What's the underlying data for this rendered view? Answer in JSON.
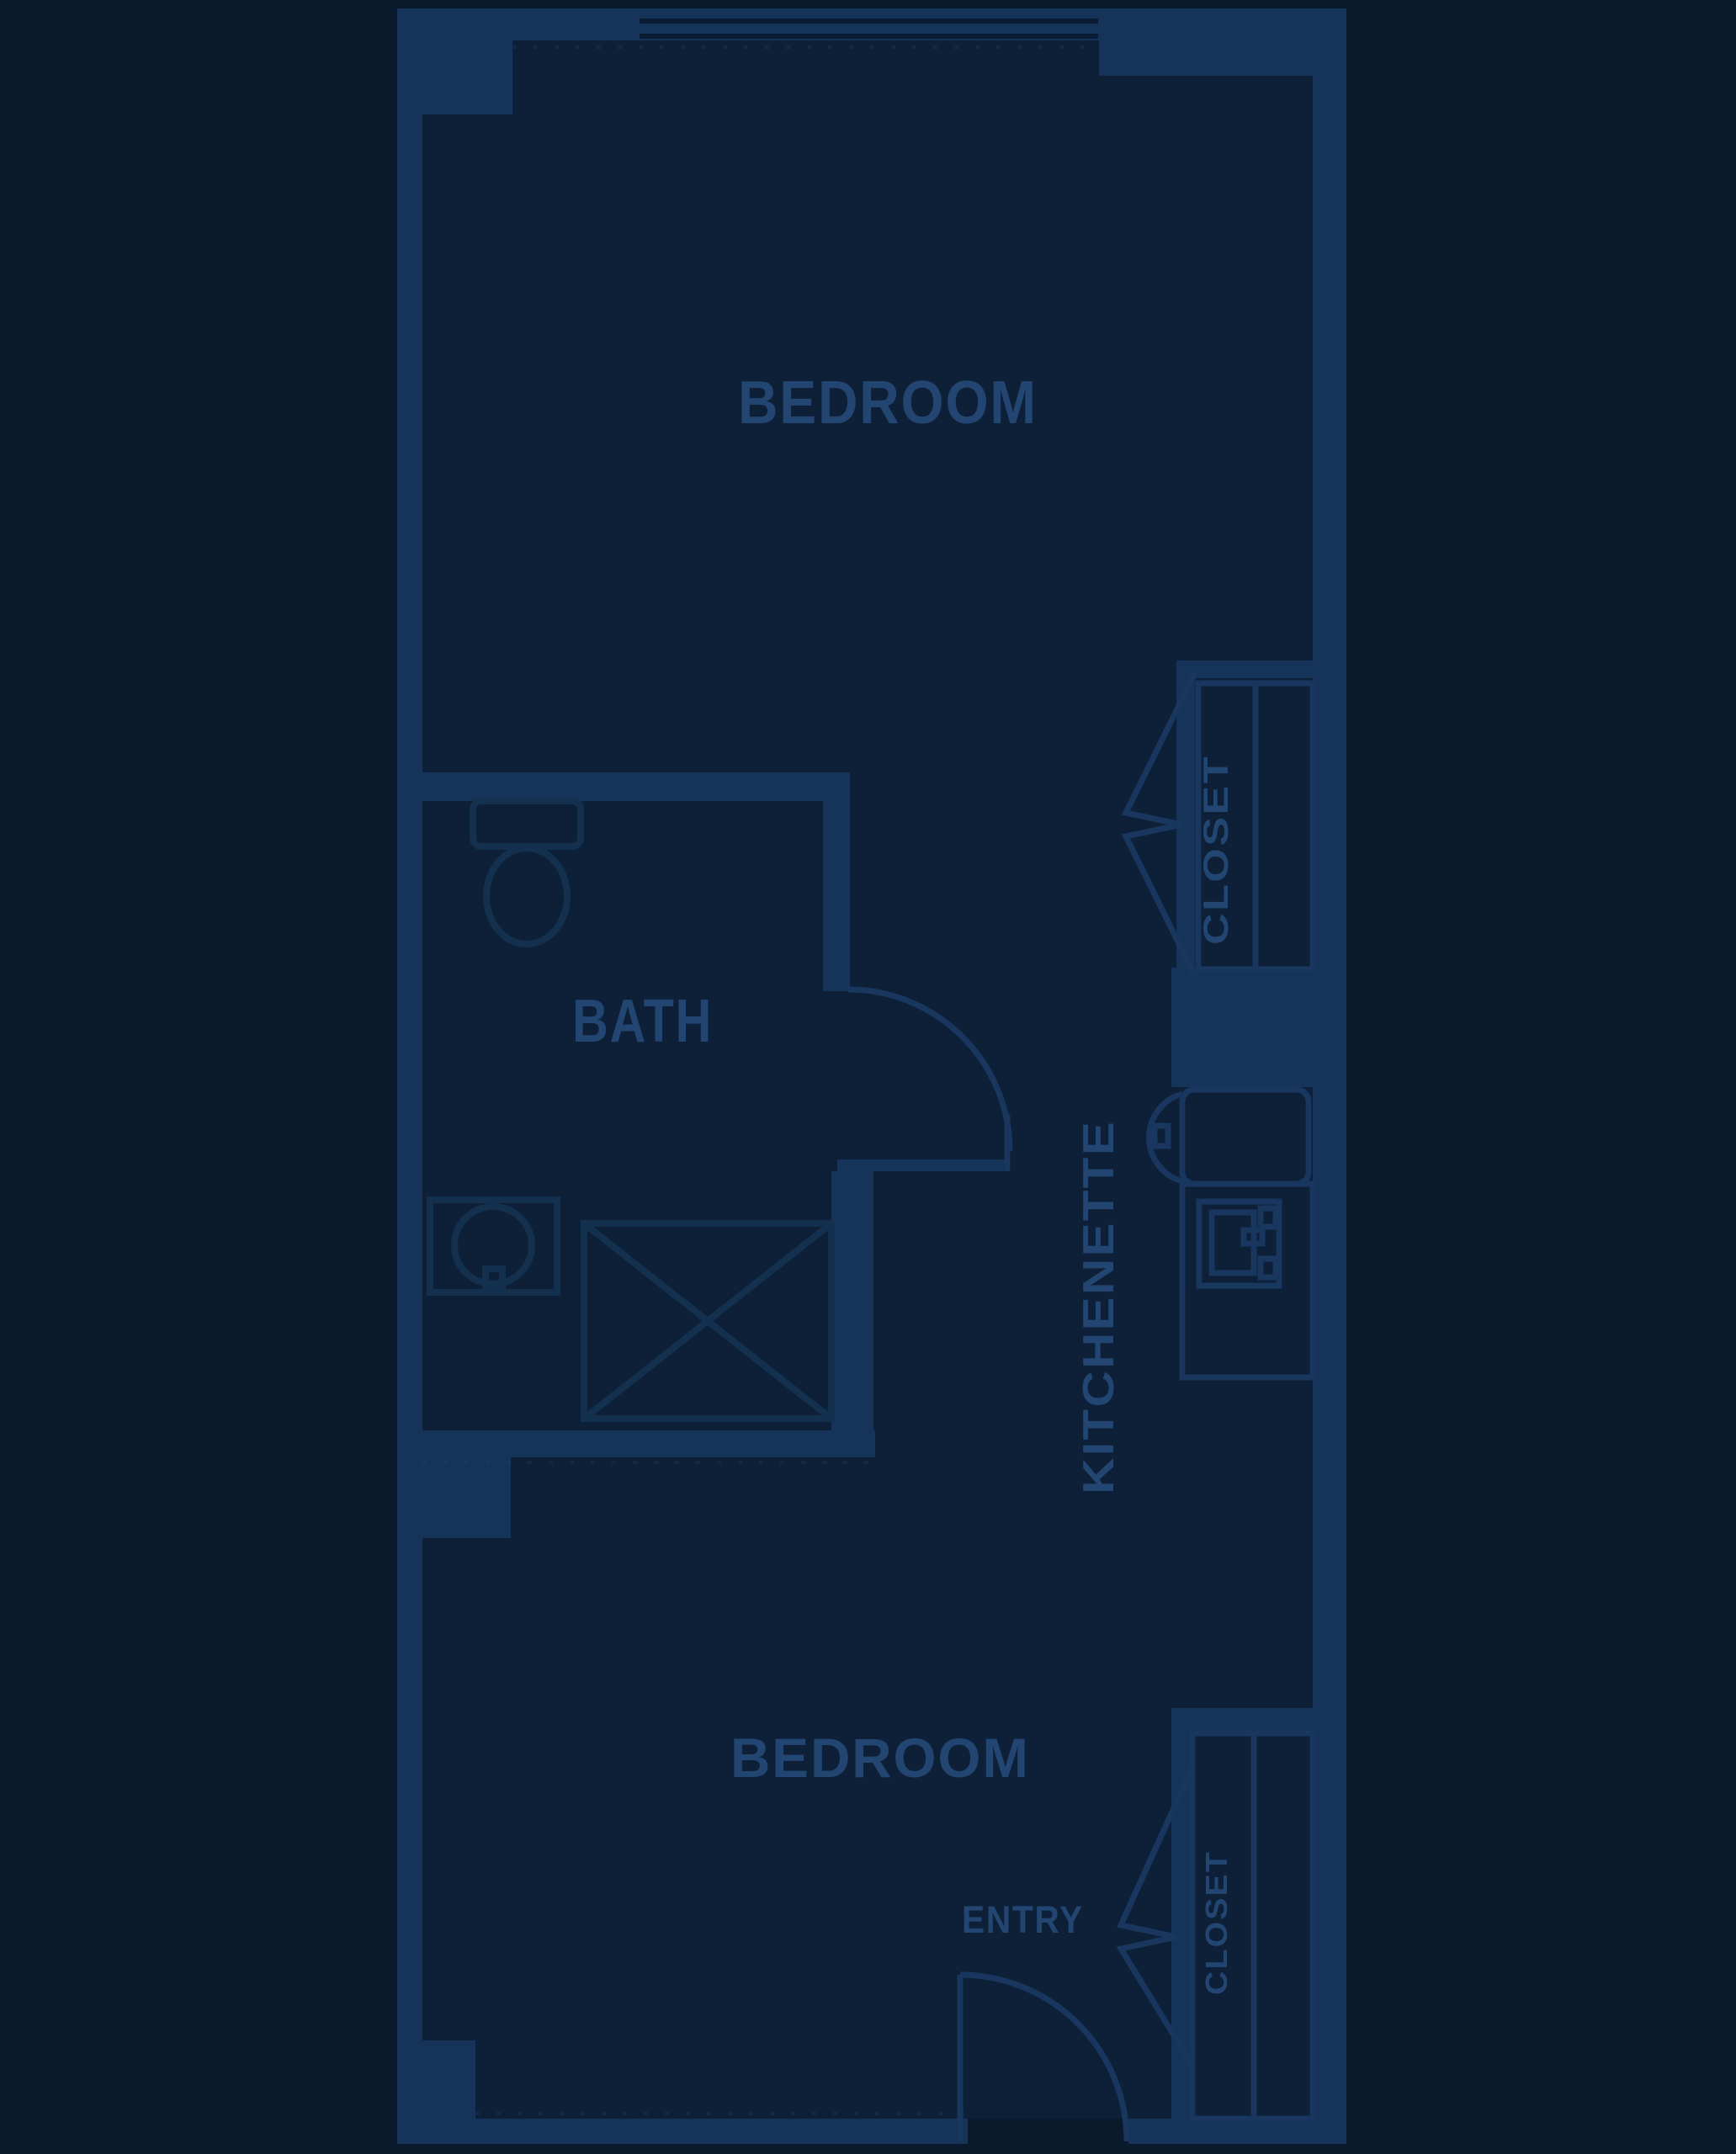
{
  "document": {
    "type": "apartment-floor-plan",
    "theme": "dark-navy-blueprint"
  },
  "colors": {
    "page-bg": "#0a1a2d",
    "floor": "#0d2038",
    "wall": "#16335a",
    "line": "#18365e",
    "dim-line": "#14304f",
    "label": "#224671",
    "window-gap": "#0a1c33"
  },
  "labels": {
    "bedroom_top": "BEDROOM",
    "bath": "BATH",
    "closet_upper": "CLOSET",
    "kitchenette": "KITCHENETTE",
    "bedroom_bottom": "BEDROOM",
    "entry": "ENTRY",
    "closet_lower": "CLOSET"
  },
  "rooms": [
    {
      "name": "bedroom-top",
      "label": "BEDROOM"
    },
    {
      "name": "bath",
      "label": "BATH"
    },
    {
      "name": "kitchenette",
      "label": "KITCHENETTE"
    },
    {
      "name": "closet-upper",
      "label": "CLOSET"
    },
    {
      "name": "bedroom-bottom",
      "label": "BEDROOM"
    },
    {
      "name": "closet-lower",
      "label": "CLOSET"
    },
    {
      "name": "entry",
      "label": "ENTRY"
    }
  ],
  "fixtures": [
    "toilet-icon",
    "vanity-sink-icon",
    "shower-icon",
    "kitchen-sink-icon",
    "cooktop-icon",
    "bath-door-arc",
    "entry-door-arc",
    "bifold-door-upper",
    "bifold-door-lower",
    "window",
    "closet-door-panels-upper",
    "closet-door-panels-lower"
  ]
}
